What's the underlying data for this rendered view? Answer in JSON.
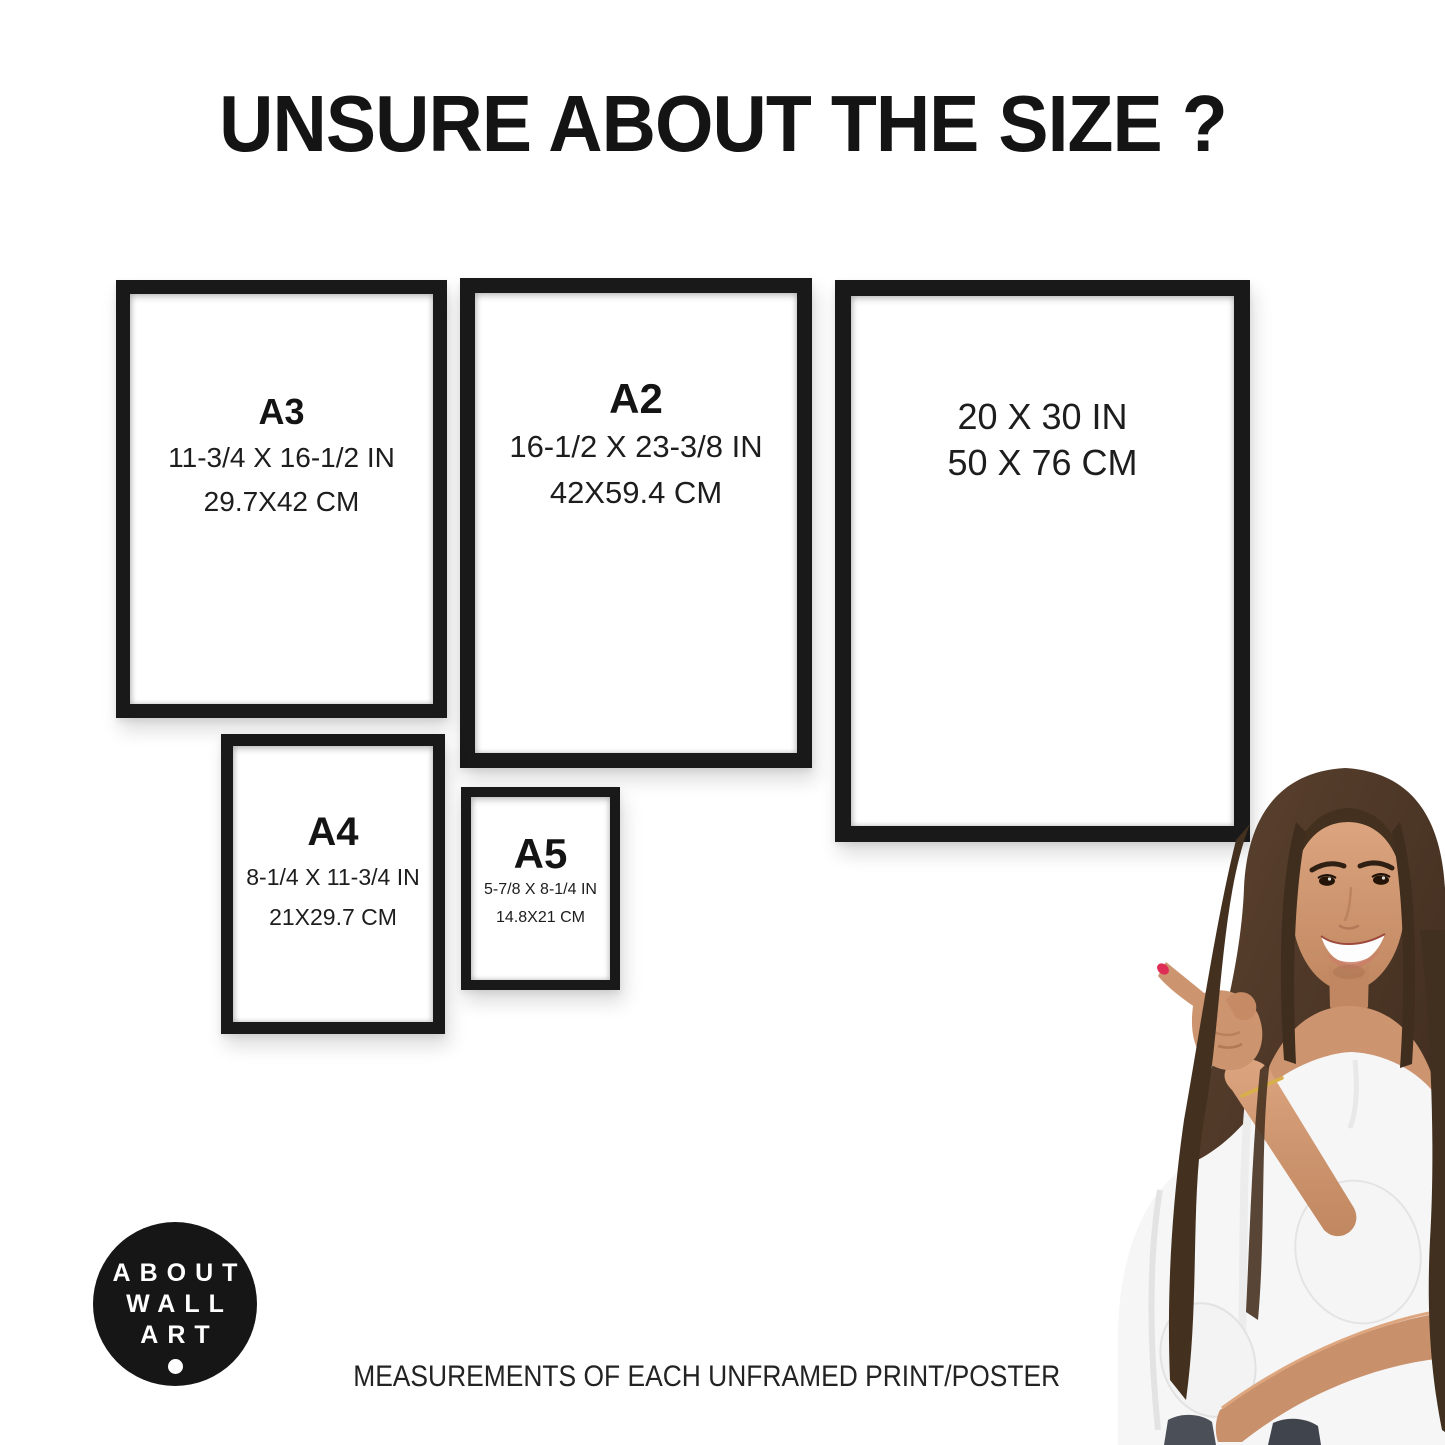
{
  "header": {
    "title": "UNSURE ABOUT THE SIZE ?"
  },
  "frames": [
    {
      "label": "A3",
      "dim_in": "11-3/4 X 16-1/2 IN",
      "dim_cm": "29.7X42 CM"
    },
    {
      "label": "A2",
      "dim_in": "16-1/2 X 23-3/8 IN",
      "dim_cm": "42X59.4 CM"
    },
    {
      "label": "",
      "dim_in": "20 X 30 IN",
      "dim_cm": "50 X 76 CM"
    },
    {
      "label": "A4",
      "dim_in": "8-1/4 X 11-3/4 IN",
      "dim_cm": "21X29.7 CM"
    },
    {
      "label": "A5",
      "dim_in": "5-7/8 X 8-1/4 IN",
      "dim_cm": "14.8X21 CM"
    }
  ],
  "logo": {
    "line1": "ABOUT",
    "line2": "WALL",
    "line3": "ART"
  },
  "footer": {
    "caption": "MEASUREMENTS OF EACH UNFRAMED PRINT/POSTER"
  },
  "colors": {
    "frame_black": "#191919",
    "text_dark": "#1b1b1b",
    "logo_bg": "#161616",
    "nail_red": "#df2e55",
    "skin": "#cd9470",
    "hair_brown": "#4a3322",
    "blouse_white": "#f6f6f6"
  }
}
